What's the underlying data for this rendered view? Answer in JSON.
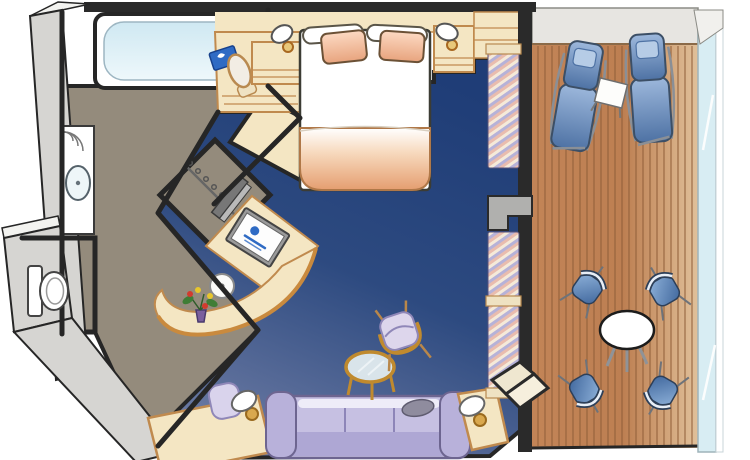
{
  "scene": {
    "type": "cruise-suite-floorplan",
    "rooms": [
      {
        "name": "bathroom",
        "items": [
          "bathtub",
          "faucet",
          "vanity-counter",
          "towel-shelves",
          "sink",
          "toilet"
        ]
      },
      {
        "name": "walk-in-closet",
        "items": [
          "hanging-rod",
          "hangers",
          "closet-door",
          "wardrobe-cabinet"
        ]
      },
      {
        "name": "bedroom",
        "items": [
          "queen-bed",
          "pillow-left",
          "pillow-right",
          "blanket",
          "nightstand-left",
          "nightstand-right",
          "wall-lamp-left",
          "wall-lamp-right",
          "vanity-desk",
          "vanity-chair",
          "brochure"
        ]
      },
      {
        "name": "living-area",
        "items": [
          "wall-tv",
          "desk-tv",
          "desk-tv-logo-icon",
          "curved-desk",
          "stool",
          "flower-arrangement",
          "writing-desk",
          "writing-chair",
          "table-lamp-left",
          "sofa",
          "throw-pillow",
          "coffee-table",
          "armchair",
          "side-table-right",
          "table-lamp-right",
          "balcony-step"
        ]
      },
      {
        "name": "balcony",
        "items": [
          "deck-planks",
          "lounger-left",
          "lounger-right",
          "lounger-table",
          "dining-table",
          "dining-chair-1",
          "dining-chair-2",
          "dining-chair-3",
          "dining-chair-4",
          "glass-railing",
          "divider-pillar",
          "curtains"
        ]
      }
    ]
  },
  "palette": {
    "page_bg": "#ffffff",
    "wall_outline": "#262626",
    "wall_gray": "#d6d5d2",
    "wall_face": "#f3f3f0",
    "wall_band": "#e7e5e1",
    "floor_taupe": "#948b7c",
    "carpet_dark": "#1f3d77",
    "carpet_mid": "#2d4a80",
    "carpet_light": "#6f7da5",
    "deck_brown": "#c28457",
    "deck_light": "#e0c09a",
    "plank_line": "#91603a",
    "cream": "#f4e6c3",
    "tan_edge": "#c08a4e",
    "gold": "#c98a3e",
    "lavender": "#c6c0e2",
    "lavender_dark": "#aea7d4",
    "lavender_line": "#6d6590",
    "blue_fabric_light": "#9db8dc",
    "blue_fabric_dark": "#4e72a4",
    "curtain_pink": "#e9bcae",
    "curtain_cream": "#f5ead9",
    "curtain_lavender": "#b6b2d8",
    "tub_blue": "#cfe8f2",
    "railing_glass": "#d8edf3",
    "brochure_blue": "#2f6bc4",
    "tv_logo_blue": "#2f6bc4",
    "blanket_peach": "#e59e70",
    "pillow_peach": "#e8a47e",
    "flower_red": "#d23b2e",
    "flower_yellow": "#e8c62c",
    "leaf_green": "#3f7d36",
    "vase_purple": "#7a5f9e"
  }
}
